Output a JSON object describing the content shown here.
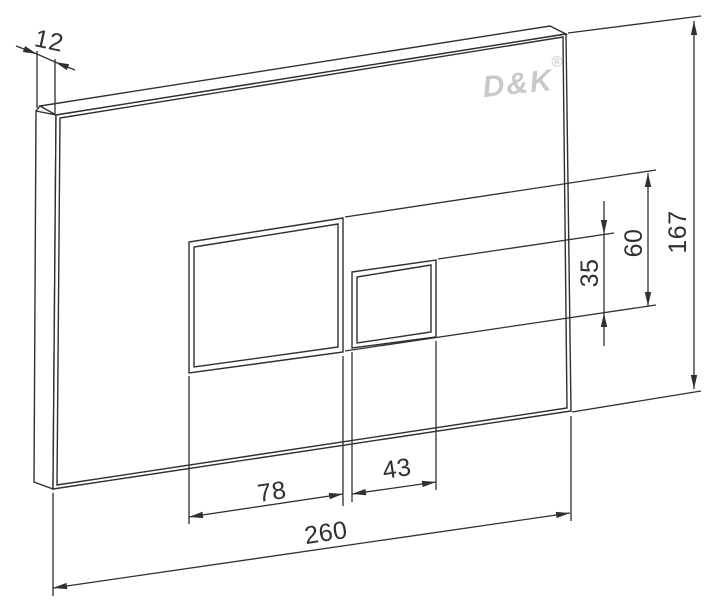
{
  "drawing": {
    "background_color": "#ffffff",
    "line_color": "#303030",
    "brand": {
      "logo_text": "D&K",
      "registered_mark": "®",
      "logo_color": "#c9c9c9"
    },
    "dimensions": {
      "plate_thickness": "12",
      "overall_width": "260",
      "overall_height": "167",
      "large_button_width": "78",
      "small_button_width": "43",
      "large_button_height": "60",
      "small_button_height": "35"
    }
  }
}
